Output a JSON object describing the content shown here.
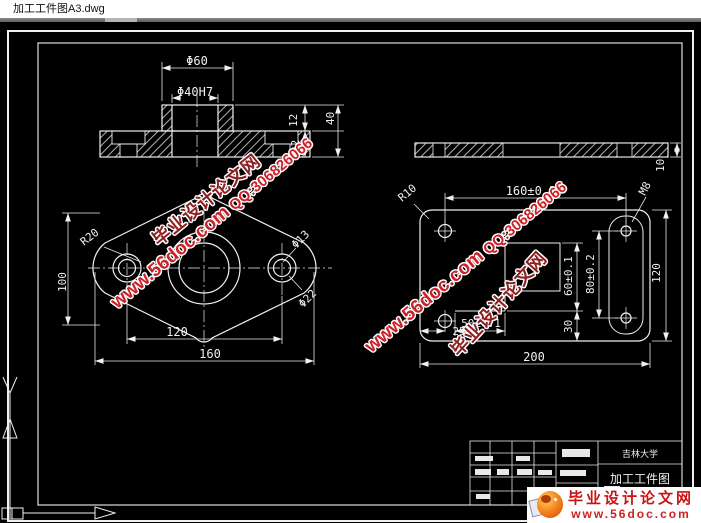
{
  "window": {
    "title": "加工工件图A3.dwg"
  },
  "brand": {
    "site": "毕业设计论文网",
    "url": "www.56doc.com",
    "qq": "QQ:306826066"
  },
  "title_block": {
    "university": "吉林大学",
    "drawing_title": "加工工件图"
  },
  "views": {
    "front_section": {
      "dia_boss": "Φ60",
      "dia_bore": "Φ40H7",
      "step_height": "12",
      "base_height": "22",
      "total_height": "40"
    },
    "plan": {
      "corner_radius": "R20",
      "height": "100",
      "hole_spacing": "120",
      "width": "160",
      "hole_dia": "Φ13",
      "cbore_dia": "Φ22"
    },
    "plate_section": {
      "thickness": "10"
    },
    "plate_plan": {
      "hole_spacing": "160±0.2",
      "corner_radius": "R10",
      "thread": "M8",
      "height": "120",
      "width": "200",
      "pocket_height": "60±0.1",
      "slot_length": "80±0.2",
      "pocket_width": "50±0.1",
      "step": "30",
      "edge_offset": "25"
    }
  },
  "colors": {
    "canvas_bg": "#000000",
    "line": "#f0f0f0",
    "watermark_red": "#cc2127",
    "watermark_dark": "#8e2022",
    "logo_red": "#cc1111",
    "titlebar_bg": "#ffffff"
  }
}
